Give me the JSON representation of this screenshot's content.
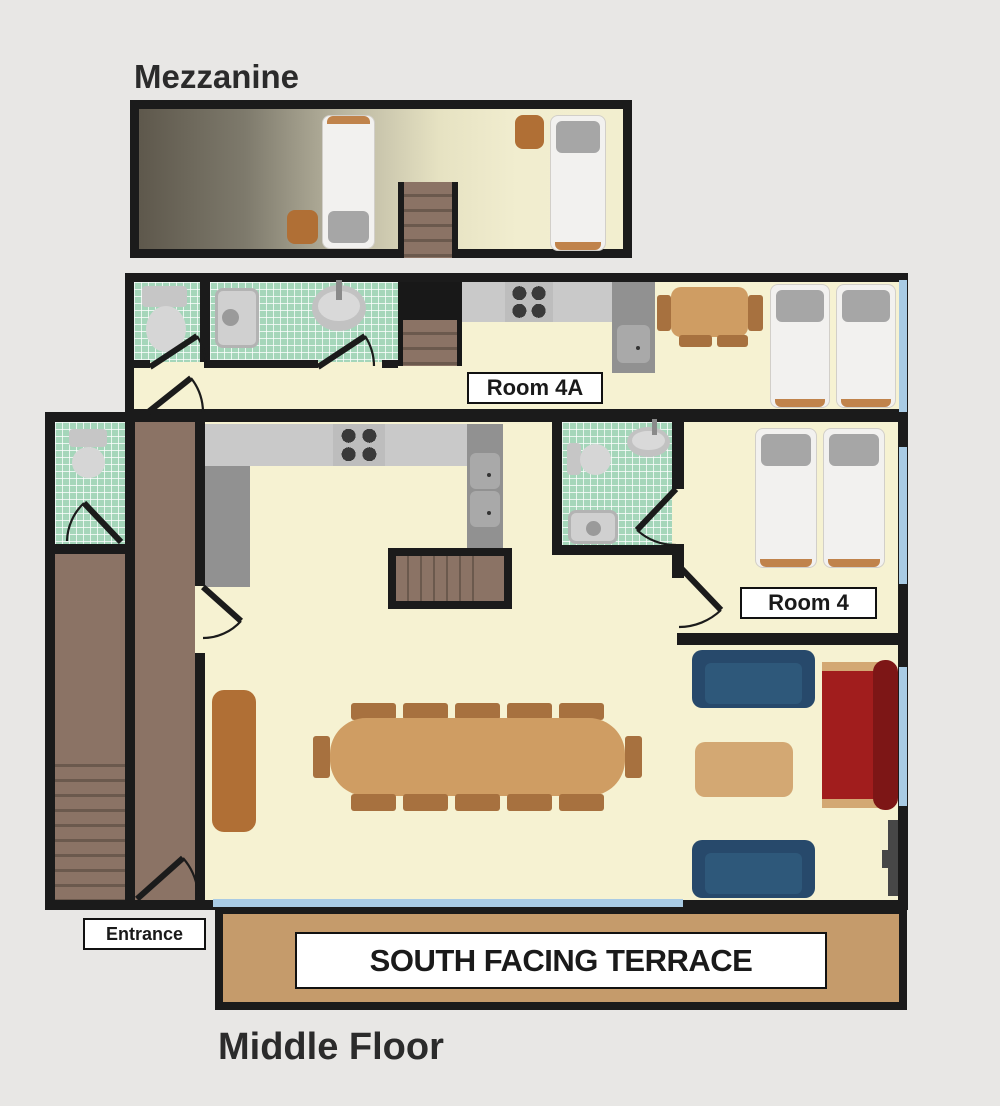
{
  "titles": {
    "mezzanine": "Mezzanine",
    "middle_floor": "Middle Floor"
  },
  "rooms": {
    "room_4a": {
      "label": "Room 4A"
    },
    "room_4": {
      "label": "Room 4"
    }
  },
  "annotations": {
    "entrance": "Entrance",
    "terrace": "SOUTH FACING TERRACE"
  },
  "colors": {
    "background": "#e8e7e5",
    "wall": "#1b1b1b",
    "floor_cream": "#f6f2d2",
    "tile_green": "#a5d6ba",
    "corridor_brown": "#8b7365",
    "stair_tread": "#6b594d",
    "counter_light": "#c9c9c9",
    "counter_dark": "#919191",
    "appliance_gray": "#bdbdbd",
    "burner_dark": "#3a3a3a",
    "bed_white": "#f2f1ef",
    "pillow_gray": "#a6a6a6",
    "bed_foot_orange": "#c0834b",
    "wood_orange": "#b06f35",
    "table_tan": "#cf9d63",
    "chair_brown": "#a7713f",
    "sofa_blue": "#2e587a",
    "sofa_blue_dark": "#27496b",
    "sofa_red": "#a11d1d",
    "sofa_red_dark": "#7d1616",
    "coffee_tan": "#d3a873",
    "terrace_tan": "#c59b6b",
    "window_blue": "#a9cbe4",
    "stairwell_black": "#181818",
    "mezz_gradient_dark": "#5e584c",
    "text_dark": "#2b2b2b"
  }
}
